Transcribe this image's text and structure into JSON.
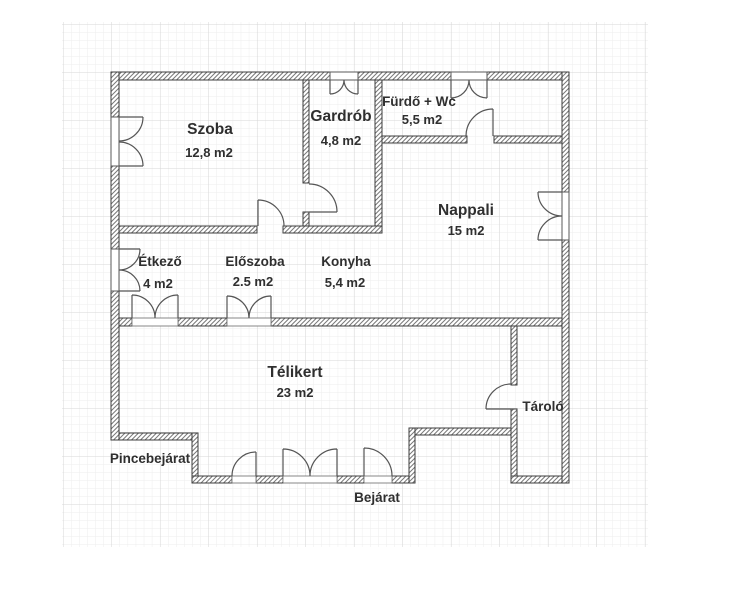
{
  "plan": {
    "type": "floor-plan",
    "rooms": [
      {
        "name": "Szoba",
        "area": "12,8 m2"
      },
      {
        "name": "Gardrób",
        "area": "4,8 m2"
      },
      {
        "name": "Fürdő + Wc",
        "area": "5,5 m2"
      },
      {
        "name": "Nappali",
        "area": "15 m2"
      },
      {
        "name": "Étkező",
        "area": "4 m2"
      },
      {
        "name": "Előszoba",
        "area": "2.5 m2"
      },
      {
        "name": "Konyha",
        "area": "5,4 m2"
      },
      {
        "name": "Télikert",
        "area": "23 m2"
      },
      {
        "name": "Tároló",
        "area": ""
      }
    ],
    "annotations": [
      {
        "text": "Pincebejárat"
      },
      {
        "text": "Bejárat"
      }
    ],
    "colors": {
      "background": "#ffffff",
      "grid_minor": "#ededed",
      "grid_major": "#d7d7d7",
      "wall_outline": "#3c3c3c",
      "wall_hatch": "#787878",
      "symbol": "#555555",
      "text": "#2f2f2f"
    }
  }
}
